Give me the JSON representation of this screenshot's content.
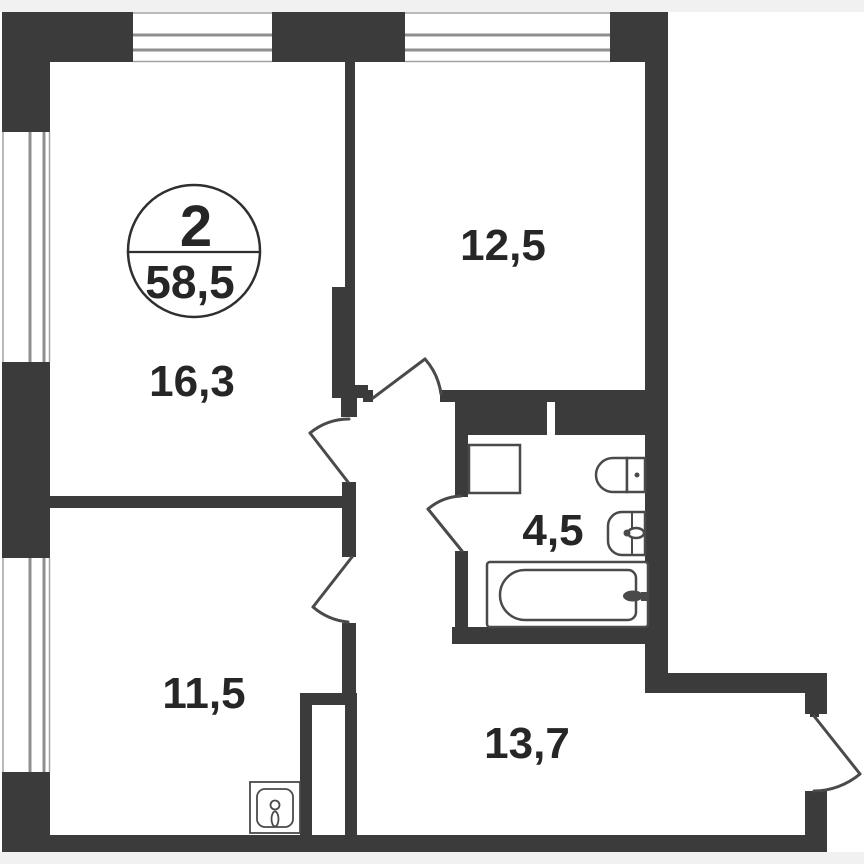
{
  "plan": {
    "title": "apartment-floor-plan",
    "unit_badge": {
      "room_count": "2",
      "total_area": "58,5"
    },
    "rooms": [
      {
        "name": "living-room",
        "area": "16,3"
      },
      {
        "name": "bedroom",
        "area": "12,5"
      },
      {
        "name": "kitchen",
        "area": "11,5"
      },
      {
        "name": "bathroom",
        "area": "4,5"
      },
      {
        "name": "hallway",
        "area": "13,7"
      }
    ],
    "fixtures": [
      "bathtub-icon",
      "toilet-icon",
      "washbasin-icon",
      "washing-machine-icon",
      "kitchen-sink-icon",
      "window-icon",
      "door-swing-icon",
      "vent-shaft"
    ],
    "colors": {
      "wall": "#3b3b3b",
      "fixture_line": "#4a4a4a",
      "window_line": "#8f8f8f",
      "text": "#262626",
      "page_margin": "#f1f1f1",
      "plan_background": "#ffffff"
    }
  }
}
